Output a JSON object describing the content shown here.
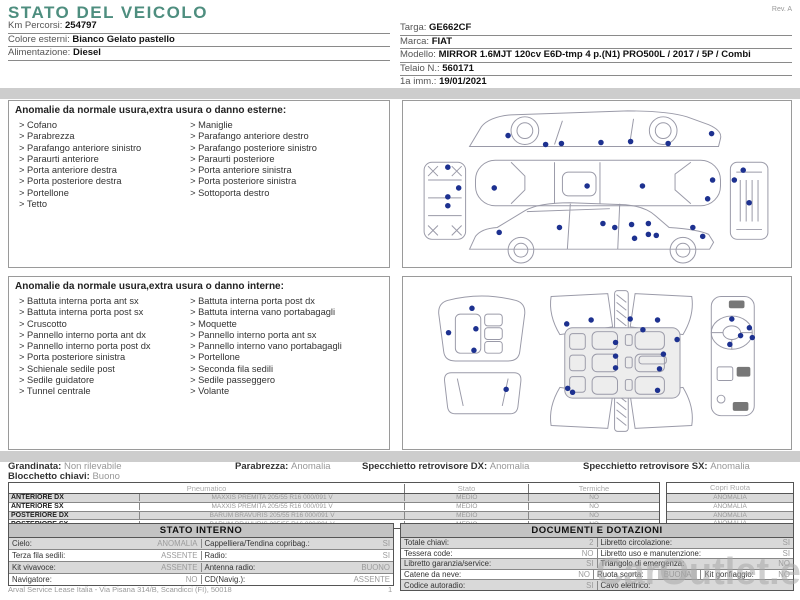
{
  "page": {
    "title": "STATO DEL VEICOLO",
    "rev": "Rev. A",
    "footer": "Arval Service Lease Italia - Via Pisana 314/B, Scandicci (FI), 50018",
    "page_number": "1",
    "watermark": "CarOutlet.eu"
  },
  "colors": {
    "accent_teal": "#4e8e7f",
    "damage_dot": "#1d3190",
    "band_gray": "#cdcdcd",
    "row_shade": "#d9d9d9"
  },
  "vehicle_info": {
    "left": [
      {
        "label": "Km Percorsi:",
        "value": "254797"
      },
      {
        "label": "Colore esterni:",
        "value": "Bianco Gelato pastello"
      },
      {
        "label": "Alimentazione:",
        "value": "Diesel"
      }
    ],
    "right": [
      {
        "label": "Targa:",
        "value": "GE662CF"
      },
      {
        "label": "Marca:",
        "value": "FIAT"
      },
      {
        "label": "Modello:",
        "value": "MIRROR 1.6MJT 120cv E6D-tmp 4 p.(N1) PRO500L / 2017 / 5P / Combi"
      },
      {
        "label": "Telaio N.:",
        "value": "560171"
      },
      {
        "label": "1a imm.:",
        "value": "19/01/2021"
      }
    ]
  },
  "exterior_section": {
    "title": "Anomalie da normale usura,extra usura o danno esterne:",
    "column1": [
      "Cofano",
      "Parabrezza",
      "Parafango anteriore sinistro",
      "Paraurti anteriore",
      "Porta anteriore destra",
      "Porta posteriore destra",
      "Portellone",
      "Tetto"
    ],
    "column2": [
      "Maniglie",
      "Parafango anteriore destro",
      "Parafango posteriore sinistro",
      "Paraurti posteriore",
      "Porta anteriore sinistra",
      "Porta posteriore sinistra",
      "Sottoporta destro"
    ],
    "diagram": {
      "dots": [
        [
          105,
          35
        ],
        [
          143,
          44
        ],
        [
          159,
          43
        ],
        [
          199,
          42
        ],
        [
          229,
          41
        ],
        [
          267,
          43
        ],
        [
          311,
          33
        ],
        [
          44,
          67
        ],
        [
          55,
          88
        ],
        [
          44,
          97
        ],
        [
          44,
          106
        ],
        [
          91,
          88
        ],
        [
          185,
          86
        ],
        [
          241,
          86
        ],
        [
          307,
          99
        ],
        [
          312,
          80
        ],
        [
          343,
          70
        ],
        [
          334,
          80
        ],
        [
          349,
          103
        ],
        [
          96,
          133
        ],
        [
          157,
          128
        ],
        [
          201,
          124
        ],
        [
          213,
          128
        ],
        [
          230,
          125
        ],
        [
          247,
          124
        ],
        [
          247,
          135
        ],
        [
          233,
          139
        ],
        [
          255,
          136
        ],
        [
          292,
          128
        ],
        [
          302,
          137
        ]
      ]
    }
  },
  "interior_section": {
    "title": "Anomalie da normale usura,extra usura o danno interne:",
    "column1": [
      "Battuta interna porta ant sx",
      "Battuta interna porta post sx",
      "Cruscotto",
      "Pannello interno porta ant dx",
      "Pannello interno porta post dx",
      "Porta posteriore sinistra",
      "Schienale sedile post",
      "Sedile guidatore",
      "Tunnel centrale"
    ],
    "column2": [
      "Battuta interna porta post dx",
      "Battuta interna vano portabagagli",
      "Moquette",
      "Pannello interno porta ant sx",
      "Pannello interno vano portabagagli",
      "Portellone",
      "Seconda fila sedili",
      "Sedile passeggero",
      "Volante"
    ],
    "diagram": {
      "dots": [
        [
          67,
          32
        ],
        [
          71,
          53
        ],
        [
          69,
          75
        ],
        [
          43,
          57
        ],
        [
          102,
          115
        ],
        [
          164,
          48
        ],
        [
          189,
          44
        ],
        [
          229,
          43
        ],
        [
          257,
          44
        ],
        [
          242,
          54
        ],
        [
          277,
          64
        ],
        [
          214,
          67
        ],
        [
          214,
          81
        ],
        [
          263,
          79
        ],
        [
          214,
          93
        ],
        [
          259,
          94
        ],
        [
          165,
          114
        ],
        [
          170,
          118
        ],
        [
          257,
          116
        ],
        [
          333,
          43
        ],
        [
          351,
          52
        ],
        [
          354,
          62
        ],
        [
          331,
          69
        ],
        [
          342,
          60
        ]
      ]
    }
  },
  "condition_summary": {
    "row1": [
      {
        "label": "Grandinata:",
        "value": "Non rilevabile"
      },
      {
        "label": "Parabrezza:",
        "value": "Anomalia"
      },
      {
        "label": "Specchietto retrovisore DX:",
        "value": "Anomalia"
      },
      {
        "label": "Specchietto retrovisore SX:",
        "value": "Anomalia"
      }
    ],
    "row2": [
      {
        "label": "Blocchetto chiavi:",
        "value": "Buono"
      }
    ]
  },
  "tyre_table": {
    "headers": {
      "pneumatico": "Pneumatico",
      "stato": "Stato",
      "termiche": "Termiche",
      "copri_ruota": "Copri Ruota"
    },
    "rows": [
      {
        "position": "ANTERIORE DX",
        "tyre": "MAXXIS PREMITA 205/55 R16 000/091 V",
        "stato": "MEDIO",
        "termiche": "NO",
        "copri_ruota": "ANOMALIA"
      },
      {
        "position": "ANTERIORE SX",
        "tyre": "MAXXIS PREMITA 205/55 R16 000/091 V",
        "stato": "MEDIO",
        "termiche": "NO",
        "copri_ruota": "ANOMALIA"
      },
      {
        "position": "POSTERIORE DX",
        "tyre": "BARUM BRAVURIS 205/55 R16 000/091 V",
        "stato": "MEDIO",
        "termiche": "NO",
        "copri_ruota": "ANOMALIA"
      },
      {
        "position": "POSTERIORE SX",
        "tyre": "BARUM BRAVURIS 205/55 R16 000/091 V",
        "stato": "MEDIO",
        "termiche": "NO",
        "copri_ruota": "ANOMALIA"
      }
    ]
  },
  "stato_interno": {
    "title": "STATO INTERNO",
    "rows": [
      [
        {
          "label": "Cielo:",
          "value": "ANOMALIA"
        },
        {
          "label": "Cappelliera/Tendina copribag.:",
          "value": "SI"
        }
      ],
      [
        {
          "label": "Terza fila sedili:",
          "value": "ASSENTE"
        },
        {
          "label": "Radio:",
          "value": "SI"
        }
      ],
      [
        {
          "label": "Kit vivavoce:",
          "value": "ASSENTE"
        },
        {
          "label": "Antenna radio:",
          "value": "BUONO"
        }
      ],
      [
        {
          "label": "Navigatore:",
          "value": "NO"
        },
        {
          "label": "CD(Navig.):",
          "value": "ASSENTE"
        }
      ]
    ]
  },
  "documenti_dotazioni": {
    "title": "DOCUMENTI E DOTAZIONI",
    "rows": [
      [
        {
          "label": "Totale chiavi:",
          "value": "2"
        },
        {
          "label": "Libretto circolazione:",
          "value": "SI"
        }
      ],
      [
        {
          "label": "Tessera code:",
          "value": "NO"
        },
        {
          "label": "Libretto uso e manutenzione:",
          "value": "SI"
        }
      ],
      [
        {
          "label": "Libretto garanzia/service:",
          "value": "SI"
        },
        {
          "label": "Triangolo di emergenza:",
          "value": "NO"
        }
      ],
      [
        {
          "label": "Catene da neve:",
          "value": "NO"
        },
        {
          "label": "Ruota scorta:",
          "value": "BUONA",
          "shaded": true
        },
        {
          "label": "Kit gonfiaggio:",
          "value": "NO"
        }
      ],
      [
        {
          "label": "Codice autoradio:",
          "value": "SI"
        },
        {
          "label": "Cavo elettrico:",
          "value": ""
        }
      ]
    ]
  }
}
